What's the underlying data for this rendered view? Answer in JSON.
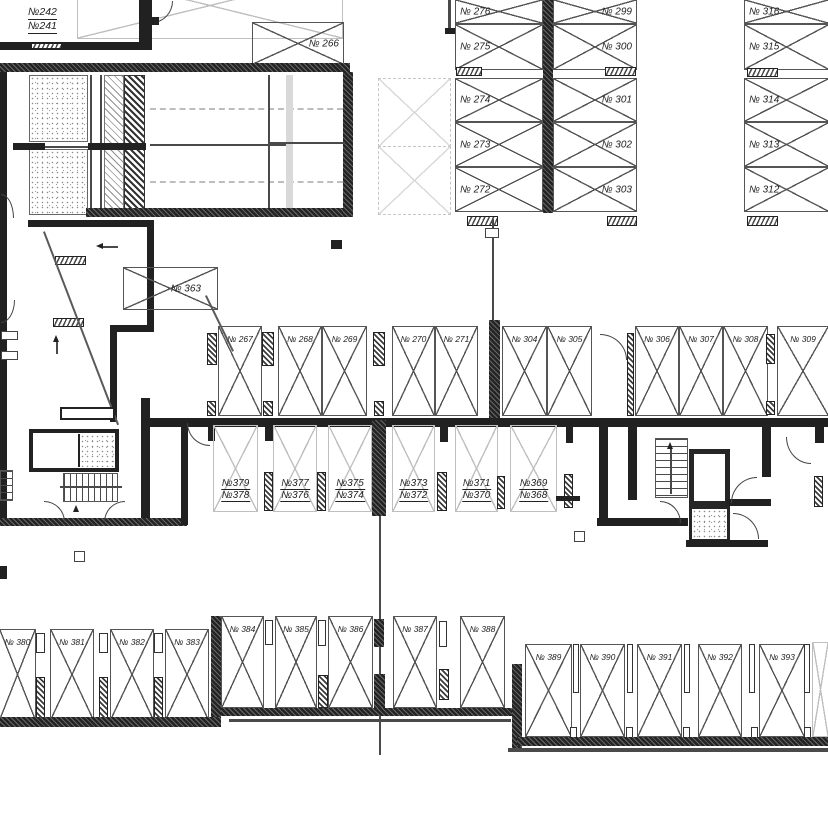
{
  "plan": {
    "type": "parking-garage-floor-plan",
    "colors": {
      "wall": "#212121",
      "box_outline": "#555555",
      "light_outline": "#bfbfbf",
      "label": "#222222"
    }
  },
  "unit_block": {
    "top": "№242",
    "bottom": "№241"
  },
  "single_boxes": {
    "s266": "№ 266",
    "s363": "№ 363"
  },
  "col_left": [
    "№ 276",
    "№ 275",
    "№ 274",
    "№ 273",
    "№ 272"
  ],
  "col_mid": [
    "№ 299",
    "№ 300",
    "№ 301",
    "№ 302",
    "№ 303"
  ],
  "col_right": [
    "№ 316",
    "№ 315",
    "№ 314",
    "№ 313",
    "№ 312"
  ],
  "mid_row": [
    "№ 267",
    "№ 268",
    "№ 269",
    "№ 270",
    "№ 271",
    "№ 304",
    "№ 305",
    "№ 306",
    "№ 307",
    "№ 308",
    "№ 309"
  ],
  "pair_row": [
    {
      "top": "№379",
      "bottom": "№378"
    },
    {
      "top": "№377",
      "bottom": "№376"
    },
    {
      "top": "№375",
      "bottom": "№374"
    },
    {
      "top": "№373",
      "bottom": "№372"
    },
    {
      "top": "№371",
      "bottom": "№370"
    },
    {
      "top": "№369",
      "bottom": "№368"
    }
  ],
  "bottom_row": [
    "№ 380",
    "№ 381",
    "№ 382",
    "№ 383",
    "№ 384",
    "№ 385",
    "№ 386",
    "№ 387",
    "№ 388",
    "№ 389",
    "№ 390",
    "№ 391",
    "№ 392",
    "№ 393"
  ]
}
